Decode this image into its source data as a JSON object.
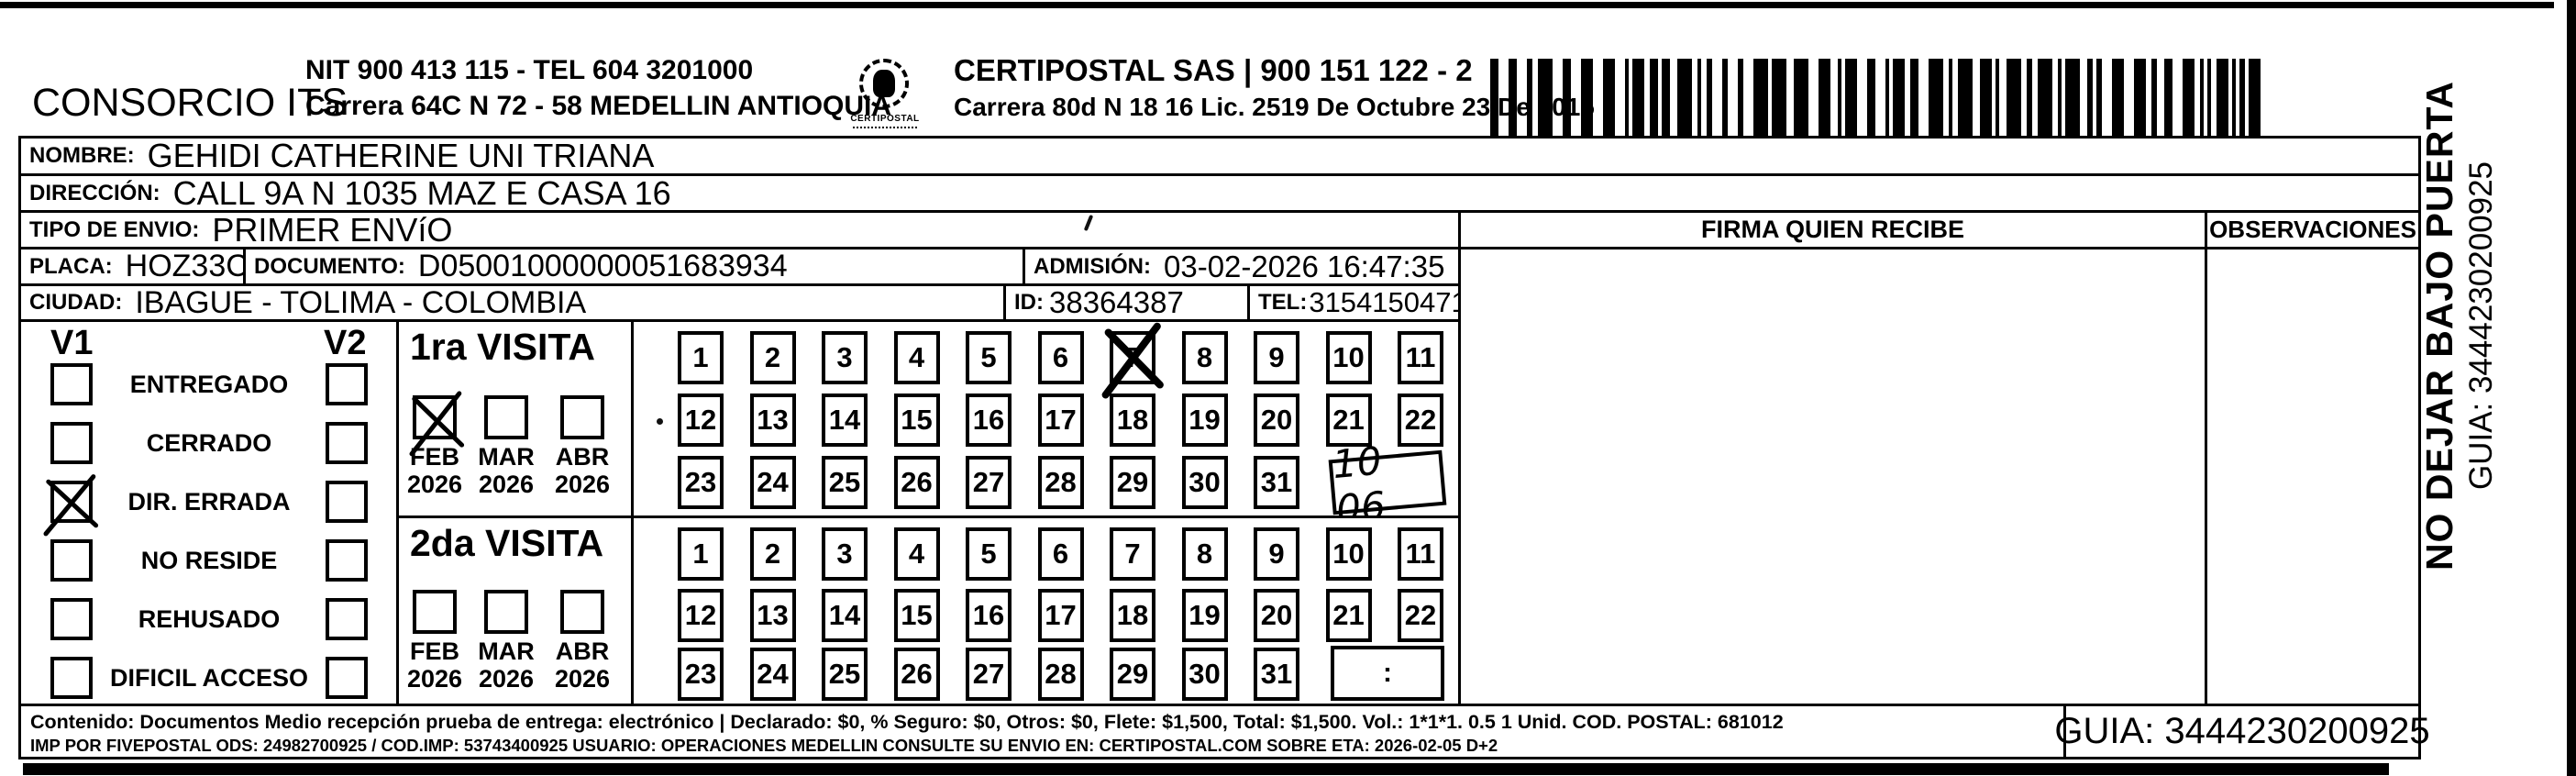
{
  "header": {
    "company_name": "CONSORCIO ITS",
    "company_nit_line": "NIT 900 413 115 - TEL 604 3201000",
    "company_address_line": "Carrera 64C N 72 - 58 MEDELLIN ANTIOQUIA",
    "logo_text": "CERTIPOSTAL",
    "operator_line1": "CERTIPOSTAL SAS | 900 151 122 - 2",
    "operator_line2": "Carrera 80d N 18 16 Lic. 2519 De Octubre 23 De 2015"
  },
  "fields": {
    "nombre": {
      "label": "NOMBRE:",
      "value": "GEHIDI CATHERINE UNI TRIANA"
    },
    "direccion": {
      "label": "DIRECCIÓN:",
      "value": "CALL 9A N 1035 MAZ E CASA 16"
    },
    "tipo_envio": {
      "label": "TIPO DE ENVIO:",
      "value": "PRIMER ENVíO"
    },
    "placa": {
      "label": "PLACA:",
      "value": "HOZ33C"
    },
    "documento": {
      "label": "DOCUMENTO:",
      "value": "D05001000000051683934"
    },
    "admision": {
      "label": "ADMISIÓN:",
      "value": "03-02-2026 16:47:35"
    },
    "ciudad": {
      "label": "CIUDAD:",
      "value": "IBAGUE - TOLIMA - COLOMBIA"
    },
    "id": {
      "label": "ID:",
      "value": "38364387"
    },
    "tel": {
      "label": "TEL:",
      "value": "3154150471"
    }
  },
  "signature_section": {
    "firma_header": "FIRMA QUIEN RECIBE",
    "observaciones_header": "OBSERVACIONES"
  },
  "status_panel": {
    "v1_label": "V1",
    "v2_label": "V2",
    "options": [
      {
        "label": "ENTREGADO",
        "v1_checked": false,
        "v2_checked": false
      },
      {
        "label": "CERRADO",
        "v1_checked": false,
        "v2_checked": false
      },
      {
        "label": "DIR. ERRADA",
        "v1_checked": true,
        "v2_checked": false
      },
      {
        "label": "NO RESIDE",
        "v1_checked": false,
        "v2_checked": false
      },
      {
        "label": "REHUSADO",
        "v1_checked": false,
        "v2_checked": false
      },
      {
        "label": "DIFICIL ACCESO",
        "v1_checked": false,
        "v2_checked": false
      }
    ]
  },
  "visits": [
    {
      "title": "1ra VISITA",
      "months": [
        {
          "month": "FEB",
          "year": "2026",
          "checked": true
        },
        {
          "month": "MAR",
          "year": "2026",
          "checked": false
        },
        {
          "month": "ABR",
          "year": "2026",
          "checked": false
        }
      ],
      "days": [
        "1",
        "2",
        "3",
        "4",
        "5",
        "6",
        "7",
        "8",
        "9",
        "10",
        "11",
        "12",
        "13",
        "14",
        "15",
        "16",
        "17",
        "18",
        "19",
        "20",
        "21",
        "22",
        "23",
        "24",
        "25",
        "26",
        "27",
        "28",
        "29",
        "30",
        "31"
      ],
      "marked_day": "7",
      "time_box": "10 06",
      "time_is_handwritten": true
    },
    {
      "title": "2da VISITA",
      "months": [
        {
          "month": "FEB",
          "year": "2026",
          "checked": false
        },
        {
          "month": "MAR",
          "year": "2026",
          "checked": false
        },
        {
          "month": "ABR",
          "year": "2026",
          "checked": false
        }
      ],
      "days": [
        "1",
        "2",
        "3",
        "4",
        "5",
        "6",
        "7",
        "8",
        "9",
        "10",
        "11",
        "12",
        "13",
        "14",
        "15",
        "16",
        "17",
        "18",
        "19",
        "20",
        "21",
        "22",
        "23",
        "24",
        "25",
        "26",
        "27",
        "28",
        "29",
        "30",
        "31"
      ],
      "marked_day": null,
      "time_box": ":",
      "time_is_handwritten": false
    }
  ],
  "footer": {
    "content_line": "Contenido: Documentos Medio recepción prueba de entrega: electrónico | Declarado: $0, % Seguro: $0, Otros: $0, Flete: $1,500, Total: $1,500. Vol.: 1*1*1. 0.5  1 Unid. COD. POSTAL: 681012",
    "imp_line": "IMP POR FIVEPOSTAL ODS: 24982700925 / COD.IMP: 53743400925 USUARIO: OPERACIONES MEDELLIN CONSULTE SU ENVIO EN: CERTIPOSTAL.COM SOBRE ETA: 2026-02-05 D+2",
    "guia": "GUIA: 3444230200925"
  },
  "side_label": {
    "warning": "NO DEJAR BAJO PUERTA",
    "guia": "GUIA: 3444230200925"
  }
}
